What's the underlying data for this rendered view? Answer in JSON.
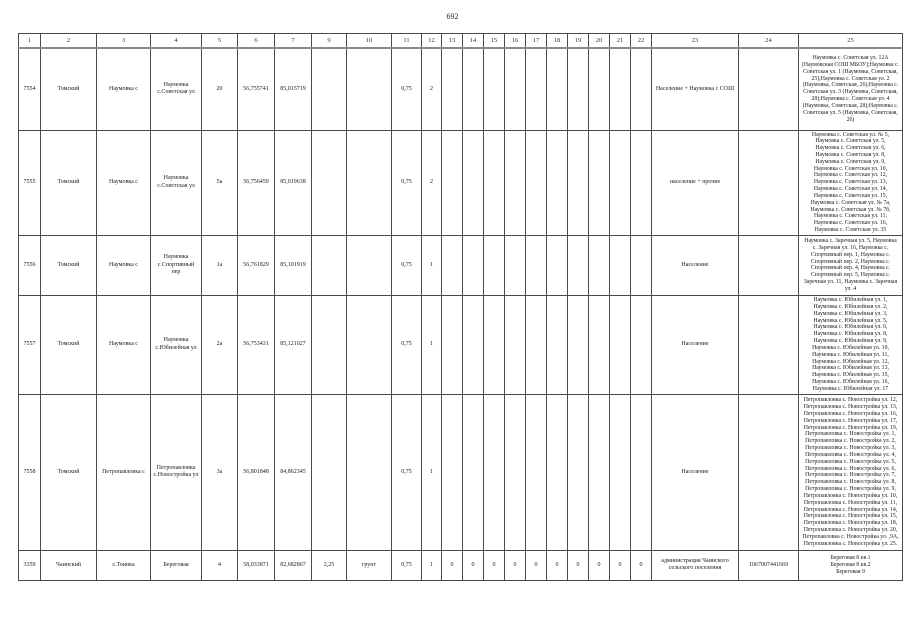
{
  "page_number": "692",
  "table": {
    "column_headers": [
      "1",
      "2",
      "3",
      "4",
      "5",
      "6",
      "7",
      "9",
      "10",
      "11",
      "12",
      "13",
      "14",
      "15",
      "16",
      "17",
      "18",
      "19",
      "20",
      "21",
      "22",
      "23",
      "24",
      "25"
    ],
    "rows": [
      {
        "cells": [
          "7554",
          "Томский",
          "Наумовка с",
          "Наумовка с.Советская ул",
          "20",
          "56,755741",
          "85,015719",
          "",
          "",
          "0,75",
          "2",
          "",
          "",
          "",
          "",
          "",
          "",
          "",
          "",
          "",
          "",
          "Население + Наумовка с СОШ",
          "",
          "Наумовка с. Советская ул. 12А (Наумовская СОШ МБОУ);Наумовка с. Советская ул. 1 (Наумовка, Советская, 25);Наумовка с. Советская ул. 2 (Наумовка, Советская, 26);Наумовка с. Советская ул. 3 (Наумовка, Советская, 28);Наумовка с. Советская ул. 4 (Наумовка, Советская, 28);Наумовка с. Советская ул. 5 (Наумовка, Советская, 26)"
        ]
      },
      {
        "cells": [
          "7555",
          "Томский",
          "Наумовка с",
          "Наумовка с.Советская ул",
          "5а",
          "56,756459",
          "85,019638",
          "",
          "",
          "0,75",
          "2",
          "",
          "",
          "",
          "",
          "",
          "",
          "",
          "",
          "",
          "",
          "население + прочие",
          "",
          "Наумовка с. Советская ул. № 5,\nНаумовка с. Советская ул. 5,\nНаумовка с. Советская ул. 6,\nНаумовка с. Советская ул. 8,\nНаумовка с. Советская ул. 9,\nНаумовка с. Советская ул. 10,\nНаумовка с. Советская ул. 12,\nНаумовка с. Советская ул. 13,\nНаумовка с. Советская ул. 14,\nНаумовка с. Советская ул. 15,\nНаумовка с. Советская ул. № 7а,\nНаумовка с. Советская ул. № 7б,\nНаумовка с. Советская ул. 11,\nНаумовка с. Советская ул. 16,\nНаумовка с. Советская ул. 35"
        ]
      },
      {
        "cells": [
          "7556",
          "Томский",
          "Наумовка с",
          "Наумовка с.Спортивный пер",
          "1а",
          "56,761829",
          "85,101919",
          "",
          "",
          "0,75",
          "1",
          "",
          "",
          "",
          "",
          "",
          "",
          "",
          "",
          "",
          "",
          "Население",
          "",
          "Наумовка с. Заречная ул. 5, Наумовка\nс. Заречная ул. 16, Наумовка с.\nСпортивный пер. 1, Наумовка с.\nСпортивный пер. 2, Наумовка с.\nСпортивный пер. 4, Наумовка с.\nСпортивный пер. 5, Наумовка с.\nЗаречная ул. 11, Наумовка с. Заречная\nул. 4"
        ]
      },
      {
        "cells": [
          "7557",
          "Томский",
          "Наумовка с",
          "Наумовка с.Юбилейная ул",
          "2а",
          "56,753431",
          "85,121027",
          "",
          "",
          "0,75",
          "1",
          "",
          "",
          "",
          "",
          "",
          "",
          "",
          "",
          "",
          "",
          "Население",
          "",
          "Наумовка с. Юбилейная ул. 1,\nНаумовка с. Юбилейная ул. 2,\nНаумовка с. Юбилейная ул. 3,\nНаумовка с. Юбилейная ул. 5,\nНаумовка с. Юбилейная ул. 6,\nНаумовка с. Юбилейная ул. 8,\nНаумовка с. Юбилейная ул. 9,\nНаумовка с. Юбилейная ул. 10,\nНаумовка с. Юбилейная ул. 11,\nНаумовка с. Юбилейная ул. 12,\nНаумовка с. Юбилейная ул. 13,\nНаумовка с. Юбилейная ул. 15,\nНаумовка с. Юбилейная ул. 16,\nНаумовка с. Юбилейная ул. 17"
        ]
      },
      {
        "cells": [
          "7558",
          "Томский",
          "Петропавловка с",
          "Петропавловка с.Новостройка ул",
          "3а",
          "56,801848",
          "84,862345",
          "",
          "",
          "0,75",
          "1",
          "",
          "",
          "",
          "",
          "",
          "",
          "",
          "",
          "",
          "",
          "Население",
          "",
          "Петропавловка с. Новостройка ул. 12,\nПетропавловка с. Новостройка ул. 13,\nПетропавловка с. Новостройка ул. 16,\nПетропавловка с. Новостройка ул. 17,\nПетропавловка с. Новостройка ул. 19,\nПетропавловка с. Новостройка ул. 1,\nПетропавловка с. Новостройка ул. 2,\nПетропавловка с. Новостройка ул. 3,\nПетропавловка с. Новостройка ул. 4,\nПетропавловка с. Новостройка ул. 5,\nПетропавловка с. Новостройка ул. 6,\nПетропавловка с. Новостройка ул. 7,\nПетропавловка с. Новостройка ул. 8,\nПетропавловка с. Новостройка ул. 9,\nПетропавловка с. Новостройка ул. 10,\nПетропавловка с. Новостройка ул. 11,\nПетропавловка с. Новостройка ул. 14,\nПетропавловка с. Новостройка ул. 15,\nПетропавловка с. Новостройка ул. 18,\nПетропавловка с. Новостройка ул. 20,\nПетропавловка с. Новостройка ул. ,9А,\nПетропавловка с. Новостройка ул. 25."
        ]
      },
      {
        "cells": [
          "3359",
          "Чаинский",
          "с.Тоинка",
          "Береговая",
          "4",
          "58,033871",
          "82,682867",
          "2,25",
          "грунт",
          "0,75",
          "1",
          "0",
          "0",
          "0",
          "0",
          "0",
          "0",
          "0",
          "0",
          "0",
          "0",
          "администрация Чаинского сельского поселения",
          "1067007441669",
          "Береговая 8 кв.1\nБереговая 8 кв.2\nБереговая 9"
        ]
      }
    ]
  }
}
